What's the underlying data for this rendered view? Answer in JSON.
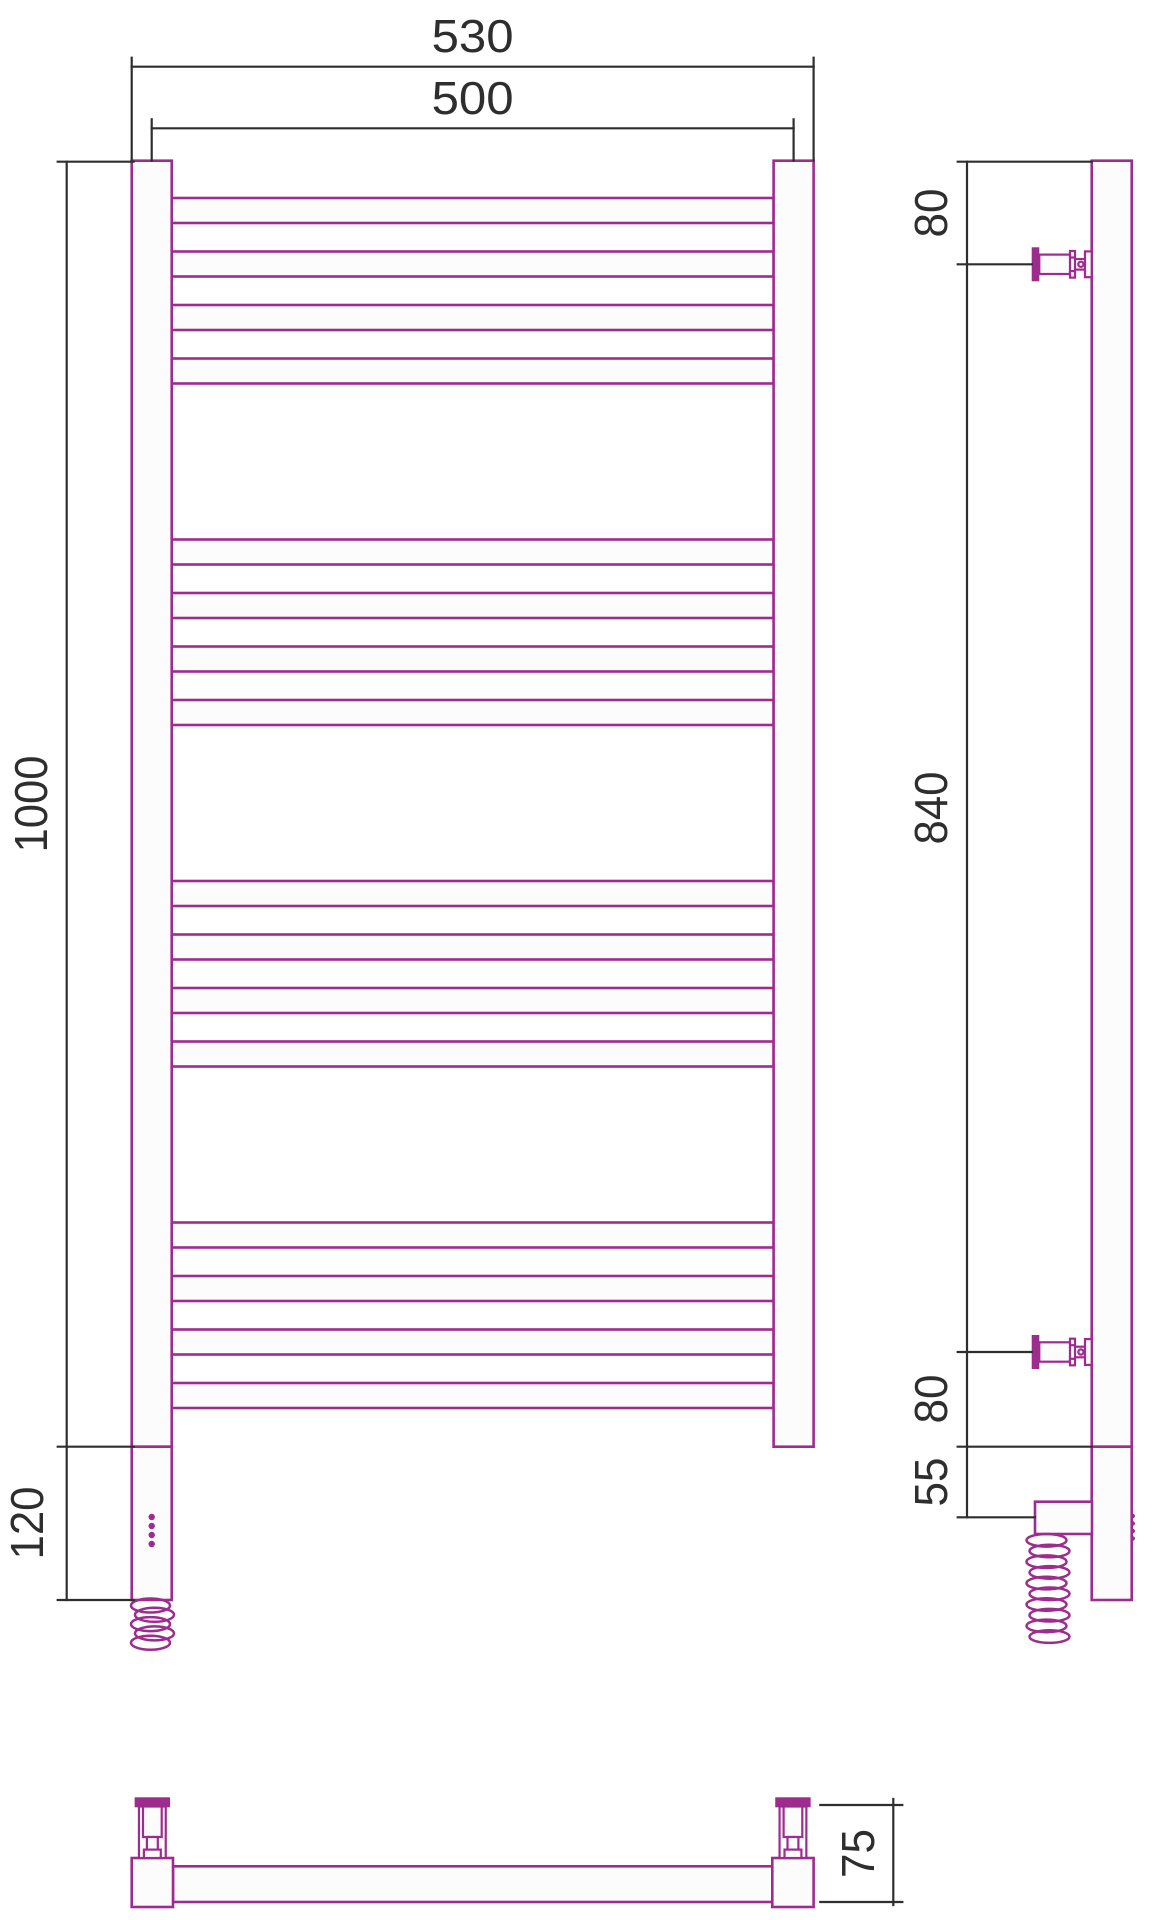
{
  "front_view": {
    "overall_width_mm": "530",
    "axis_spacing_mm": "500",
    "height_mm": "1000",
    "heater_section_mm": "120"
  },
  "side_view": {
    "top_bracket_offset_mm": "80",
    "bracket_spacing_mm": "840",
    "bottom_bracket_offset_mm": "80",
    "cable_offset_mm": "55"
  },
  "bottom_view": {
    "wall_clearance_mm": "75"
  },
  "colors": {
    "product": "#9E2B8E",
    "dimension": "#2E2E2E",
    "tube_fill": "#FDFCFD",
    "background": "#FFFFFF"
  }
}
